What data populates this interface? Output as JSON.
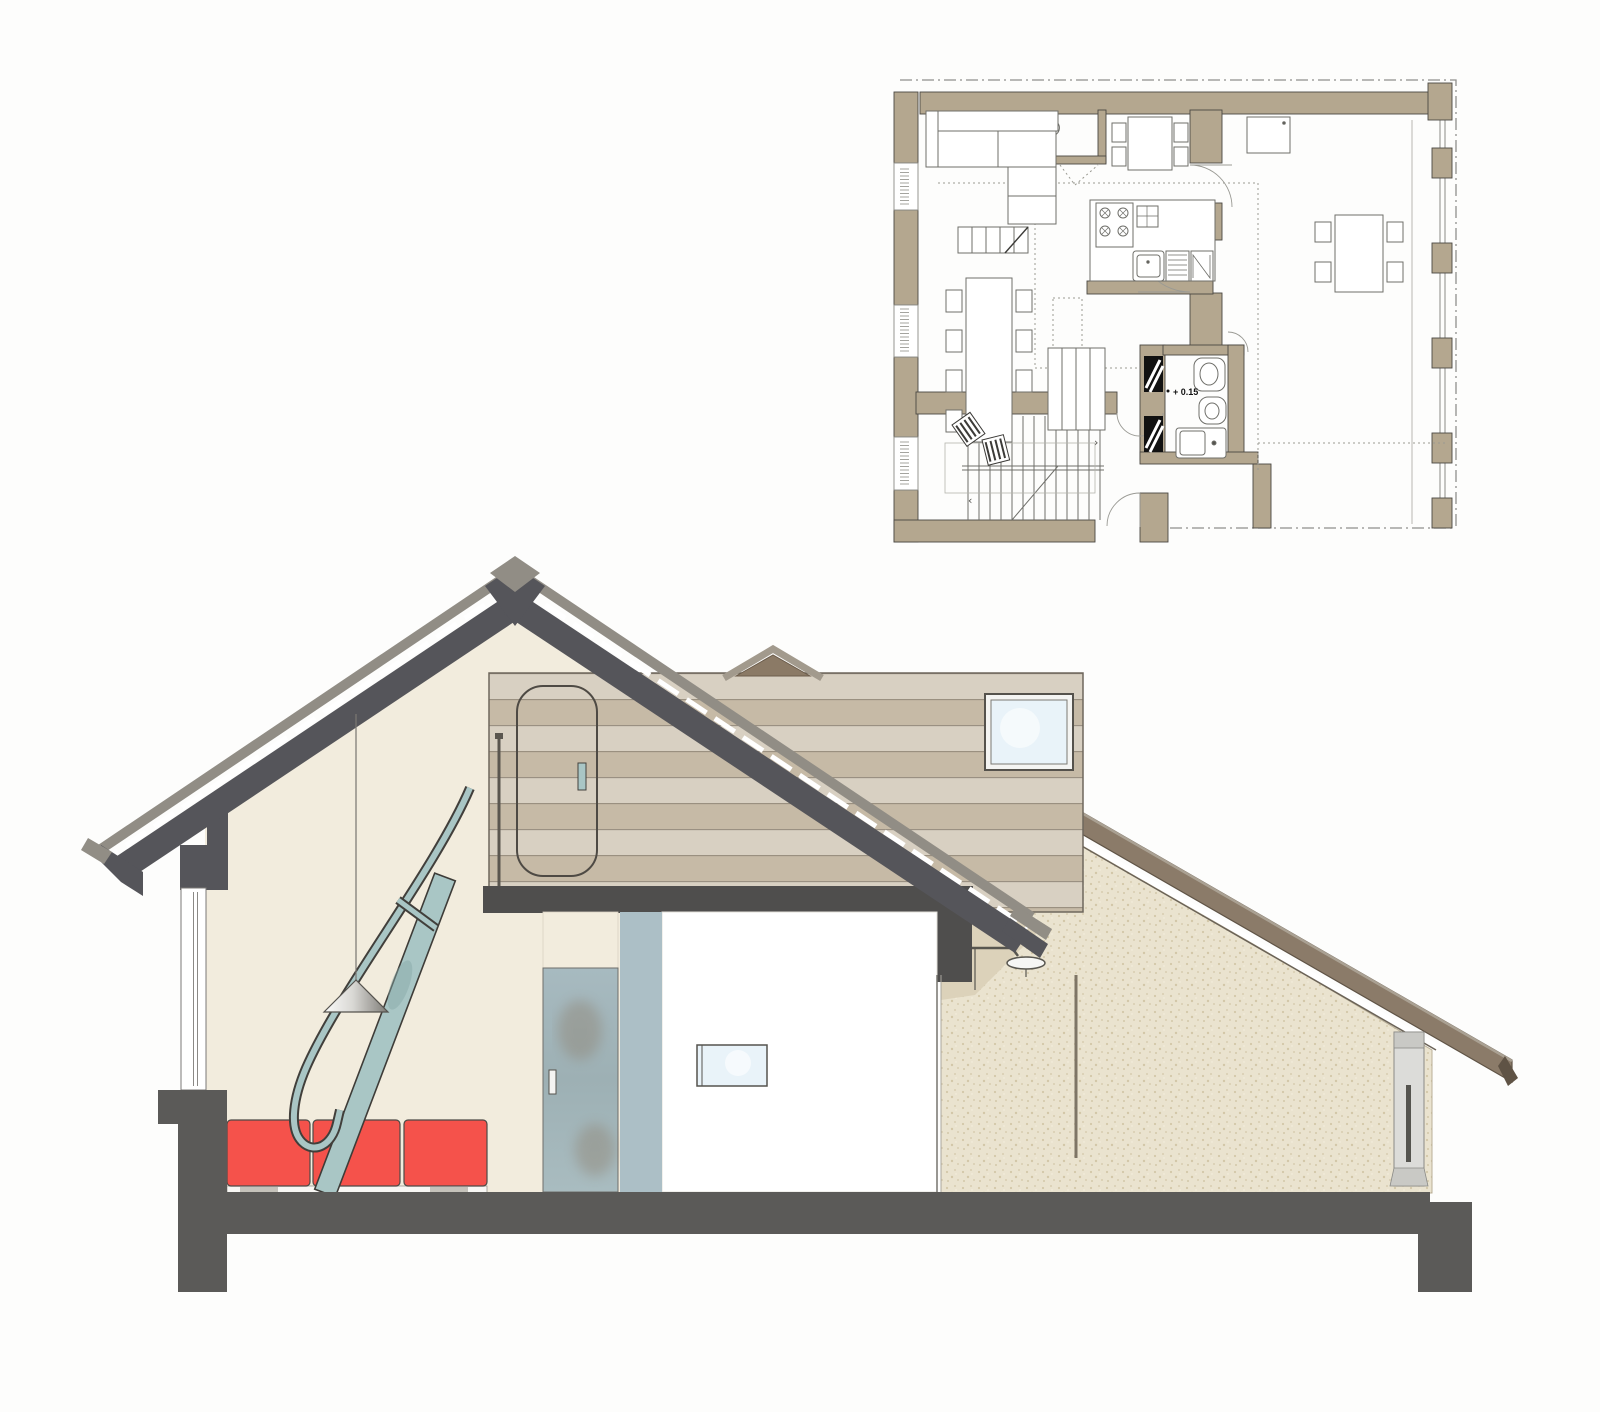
{
  "annotations": {
    "plan_level": "+ 0.15",
    "stair_up": "›",
    "stair_down": "‹"
  },
  "palette": {
    "bg": "#fdfdfc",
    "plan_wall": "#b4a78f",
    "plan_line": "#4b4843",
    "plan_thin": "#6f6f6a",
    "plan_dotted": "#9a9a92",
    "roof_dark": "#55555a",
    "roof_light": "#918d85",
    "roof_brown": "#8b7b69",
    "roof_brown_dark": "#5f5345",
    "slab": "#5b5a58",
    "cream": "#f2ecdd",
    "sand": "#eae3cf",
    "sand_speck": "#d3c7a8",
    "sand_shadow": "#dcd2ba",
    "wood_light": "#d8d0c2",
    "wood_dark": "#c6baa6",
    "wood_line": "#978d7e",
    "wood_edge": "#6e675d",
    "dormer_brown": "#8b7a66",
    "sofa_red": "#f5524b",
    "teal": "#a9c6c5",
    "teal_dark": "#3e3c38",
    "glass": "#e9f3f9",
    "glass_door": "#a7bac0",
    "glass_smudge": "#8d7f6d",
    "column": "#acbfc6",
    "pillar": "#dcdcd9",
    "pillar_cap": "#c9c9c5",
    "white_room": "#ffffff",
    "ink": "#4c4a46"
  }
}
